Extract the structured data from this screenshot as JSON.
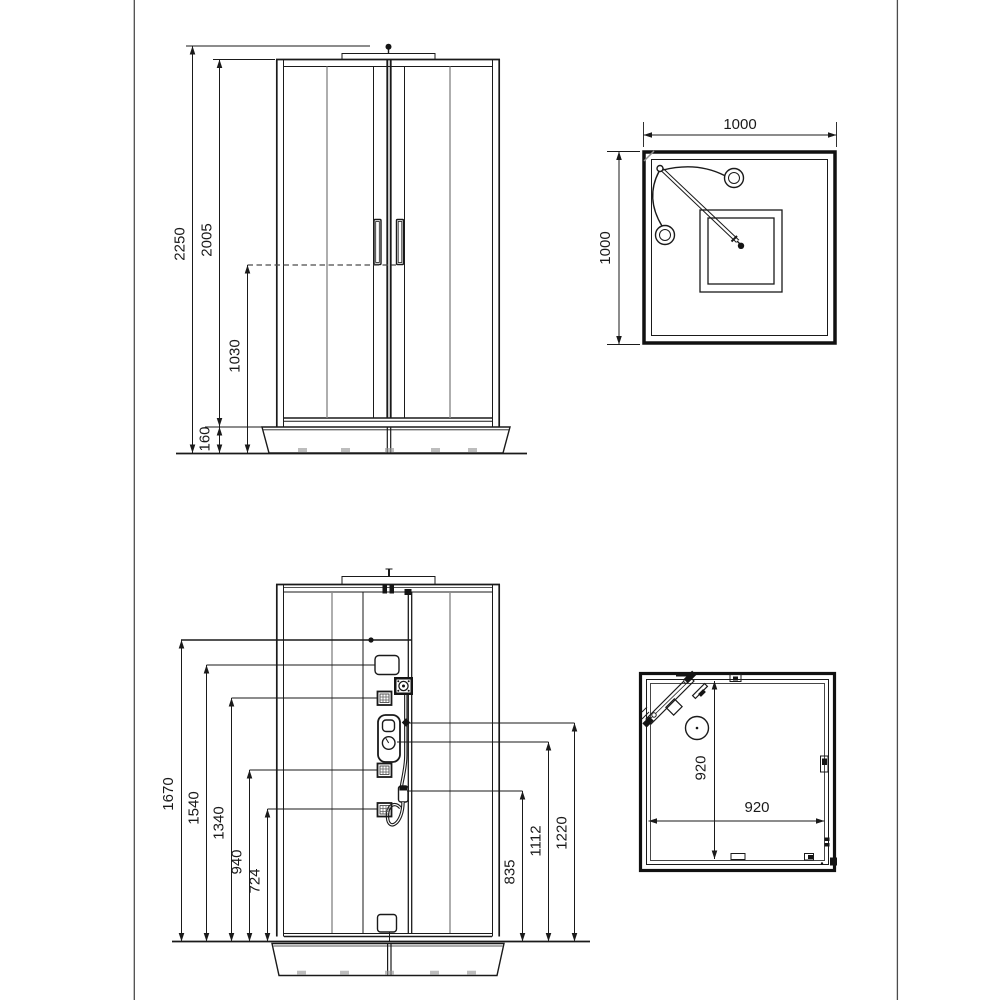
{
  "drawing": {
    "colors": {
      "background": "#ffffff",
      "line": "#1a1a1a",
      "glass_line": "#8c8c8c",
      "page_border": "#4c4c4c"
    },
    "front_exterior": {
      "total_height": "2250",
      "door_height": "2005",
      "handle_height": "1030",
      "tray_height": "160"
    },
    "plan_exterior": {
      "width": "1000",
      "depth": "1000"
    },
    "front_interior": {
      "d1670": "1670",
      "d1540": "1540",
      "d1340": "1340",
      "d940": "940",
      "d724": "724",
      "d1220": "1220",
      "d1112": "1112",
      "d835": "835"
    },
    "plan_interior": {
      "inner_depth": "920",
      "inner_width": "920"
    }
  }
}
